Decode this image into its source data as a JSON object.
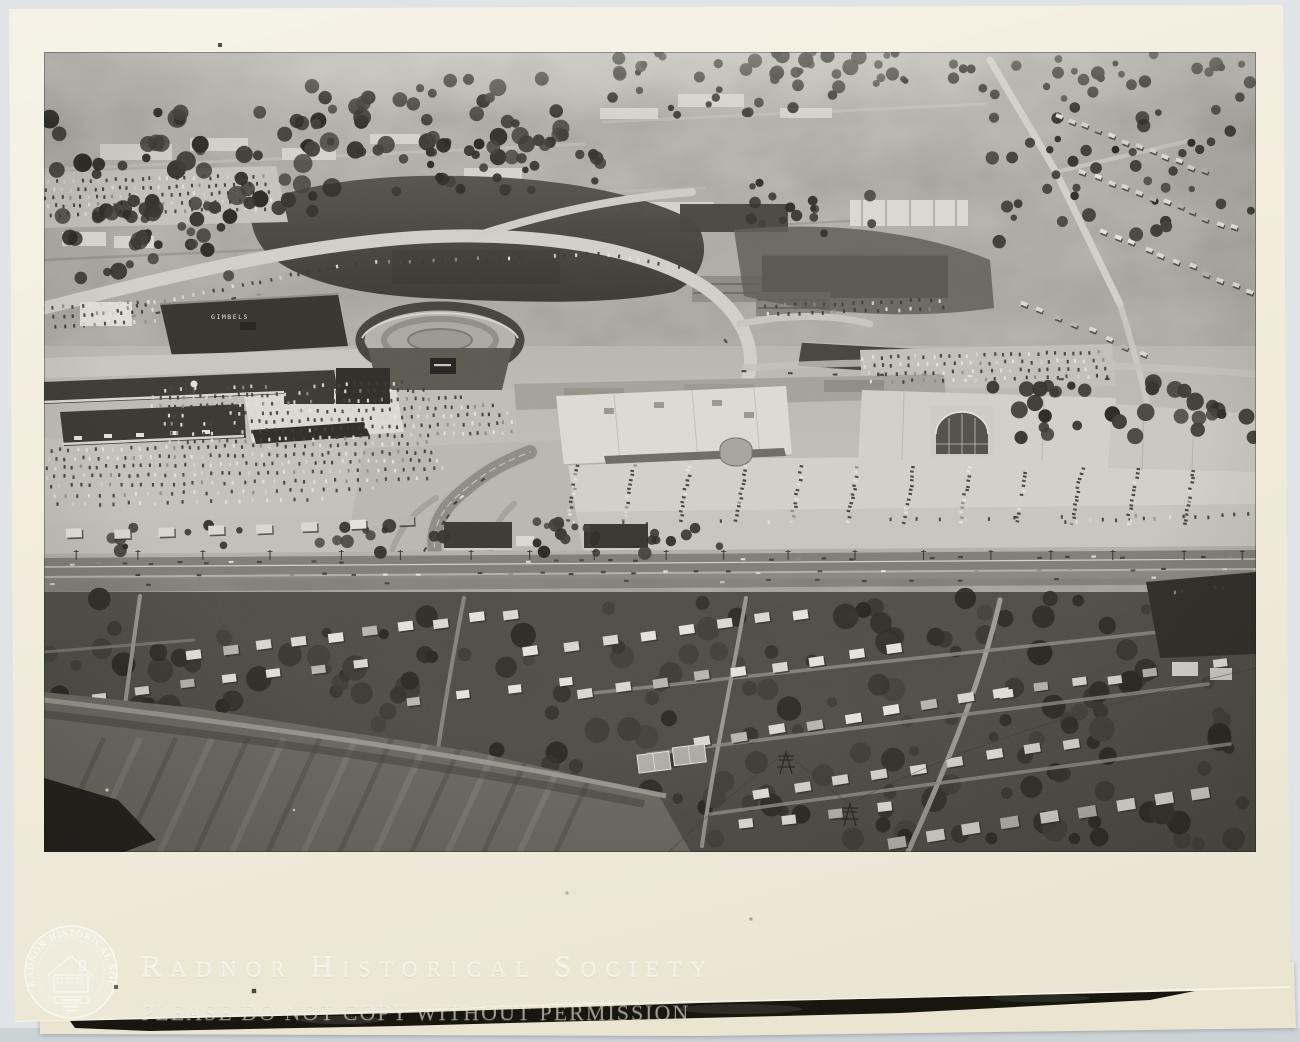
{
  "document": {
    "kind": "scanned black-and-white photographic print",
    "subject": "aerial view of a shopping mall complex, ring road, parking lots and residential neighborhood"
  },
  "scan": {
    "background_color": "#e1e4e6",
    "bottom_strip_color": "#ccd3d7",
    "paper_color": "#f1ecdb",
    "under_paper_color": "#ebe4d1",
    "wedge_color": "#17160f",
    "watermark_color": "rgba(253,251,243,0.5)"
  },
  "watermark": {
    "title": "Radnor Historical Society",
    "notice": "PLEASE DO NOT COPY WITHOUT PERMISSION",
    "seal_text": "RADNOR HISTORICAL SOCIETY"
  },
  "photo": {
    "sign_text": "GIMBELS",
    "tones": {
      "haze": "#c4c2bb",
      "base": "#b7b5ad",
      "light_lot": "#d4d2ca",
      "dark_trees": "#343229",
      "building_white": "#dedcd4",
      "building_dark": "#34322c",
      "road_light": "#d3d1c9",
      "road_dark": "#807e77"
    }
  },
  "procedural": {
    "seed": 42,
    "car_strips": [
      [
        4,
        130,
        218,
        124,
        26,
        0
      ],
      [
        2,
        138,
        222,
        132,
        28,
        0
      ],
      [
        2,
        146,
        226,
        140,
        28,
        0
      ],
      [
        4,
        154,
        228,
        148,
        28,
        0
      ],
      [
        6,
        163,
        230,
        156,
        26,
        0
      ],
      [
        0,
        256,
        104,
        250,
        12,
        0
      ],
      [
        0,
        266,
        108,
        259,
        12,
        0
      ],
      [
        0,
        276,
        110,
        268,
        12,
        0
      ],
      [
        54,
        262,
        294,
        214,
        26,
        0
      ],
      [
        300,
        212,
        554,
        202,
        24,
        0
      ],
      [
        566,
        204,
        634,
        214,
        8,
        0
      ],
      [
        722,
        254,
        896,
        248,
        19,
        0
      ],
      [
        724,
        262,
        898,
        256,
        17,
        0
      ],
      [
        820,
        306,
        1054,
        300,
        28,
        0
      ],
      [
        822,
        314,
        1058,
        308,
        28,
        0
      ],
      [
        824,
        322,
        1062,
        316,
        26,
        0
      ],
      [
        828,
        330,
        1064,
        324,
        24,
        0
      ],
      [
        112,
        338,
        358,
        331,
        32,
        0
      ],
      [
        110,
        346,
        378,
        338,
        36,
        0
      ],
      [
        108,
        355,
        418,
        346,
        40,
        0
      ],
      [
        108,
        364,
        448,
        354,
        44,
        0
      ],
      [
        112,
        373,
        462,
        362,
        45,
        0
      ],
      [
        118,
        382,
        468,
        371,
        44,
        0
      ],
      [
        126,
        391,
        468,
        380,
        42,
        0
      ],
      [
        8,
        398,
        382,
        391,
        44,
        0
      ],
      [
        4,
        407,
        388,
        400,
        46,
        0
      ],
      [
        2,
        416,
        394,
        408,
        46,
        0
      ],
      [
        2,
        425,
        398,
        417,
        44,
        0
      ],
      [
        6,
        434,
        384,
        427,
        38,
        0
      ],
      [
        10,
        444,
        328,
        437,
        28,
        0
      ],
      [
        14,
        453,
        278,
        447,
        20,
        0
      ],
      [
        534,
        414,
        524,
        468,
        13,
        0
      ],
      [
        590,
        414,
        580,
        468,
        13,
        0
      ],
      [
        646,
        414,
        636,
        468,
        13,
        0
      ],
      [
        702,
        414,
        692,
        468,
        13,
        0
      ],
      [
        758,
        415,
        748,
        469,
        13,
        0
      ],
      [
        814,
        415,
        804,
        469,
        13,
        0
      ],
      [
        870,
        415,
        860,
        470,
        13,
        0
      ],
      [
        926,
        416,
        916,
        470,
        13,
        0
      ],
      [
        982,
        416,
        972,
        470,
        13,
        0
      ],
      [
        1038,
        417,
        1028,
        471,
        13,
        0
      ],
      [
        1094,
        417,
        1084,
        471,
        13,
        0
      ],
      [
        1150,
        418,
        1140,
        472,
        13,
        0
      ],
      [
        530,
        472,
        1140,
        464,
        26,
        1
      ],
      [
        1020,
        470,
        1204,
        463,
        15,
        0
      ],
      [
        0,
        512,
        1212,
        504,
        46,
        2
      ],
      [
        0,
        524,
        1212,
        517,
        40,
        2
      ],
      [
        8,
        533,
        1204,
        526,
        26,
        2
      ],
      [
        382,
        498,
        404,
        464,
        6,
        2
      ],
      [
        410,
        450,
        438,
        428,
        5,
        2
      ],
      [
        40,
        274,
        240,
        238,
        9,
        2
      ],
      [
        652,
        252,
        690,
        298,
        6,
        2
      ],
      [
        700,
        320,
        1200,
        330,
        12,
        2
      ],
      [
        1122,
        541,
        1196,
        534,
        10,
        3
      ]
    ],
    "tree_areas": [
      [
        0,
        545,
        1212,
        248,
        230,
        5,
        13
      ],
      [
        0,
        60,
        290,
        108,
        52,
        4,
        10
      ],
      [
        246,
        26,
        330,
        82,
        55,
        4,
        9
      ],
      [
        556,
        0,
        260,
        64,
        40,
        3,
        8
      ],
      [
        830,
        0,
        380,
        48,
        36,
        3,
        7
      ],
      [
        948,
        52,
        264,
        138,
        44,
        3,
        7
      ],
      [
        0,
        148,
        208,
        78,
        30,
        4,
        9
      ],
      [
        944,
        330,
        268,
        56,
        34,
        4,
        9
      ],
      [
        426,
        468,
        256,
        34,
        22,
        3,
        7
      ],
      [
        64,
        470,
        336,
        32,
        20,
        3,
        7
      ],
      [
        700,
        130,
        128,
        58,
        16,
        3,
        6
      ],
      [
        350,
        100,
        210,
        40,
        20,
        3,
        7
      ]
    ],
    "house_rows": [
      [
        150,
        602,
        468,
        562,
        10,
        15,
        9
      ],
      [
        488,
        600,
        758,
        562,
        8,
        15,
        9
      ],
      [
        540,
        642,
        852,
        597,
        9,
        15,
        9
      ],
      [
        658,
        690,
        958,
        641,
        9,
        16,
        9
      ],
      [
        718,
        741,
        1028,
        691,
        9,
        16,
        9
      ],
      [
        852,
        790,
        1158,
        741,
        9,
        18,
        11
      ],
      [
        962,
        641,
        1178,
        612,
        7,
        14,
        8
      ],
      [
        56,
        644,
        318,
        612,
        7,
        14,
        8
      ],
      [
        368,
        648,
        520,
        630,
        4,
        13,
        8
      ],
      [
        30,
        482,
        360,
        470,
        8,
        16,
        9
      ],
      [
        700,
        772,
        840,
        756,
        4,
        14,
        9
      ],
      [
        1016,
        64,
        1160,
        120,
        12,
        7,
        4
      ],
      [
        1040,
        120,
        1190,
        176,
        12,
        7,
        4
      ],
      [
        1060,
        180,
        1205,
        238,
        11,
        7,
        4
      ],
      [
        980,
        252,
        1098,
        300,
        8,
        7,
        4
      ]
    ],
    "field_stripes": {
      "x0": 60,
      "y0": 686,
      "dx": 36,
      "n": 15,
      "drop": 118,
      "lean": 54
    },
    "poles": {
      "x0": 28,
      "step": 65,
      "n": 19,
      "y": 498,
      "h": 10
    }
  }
}
